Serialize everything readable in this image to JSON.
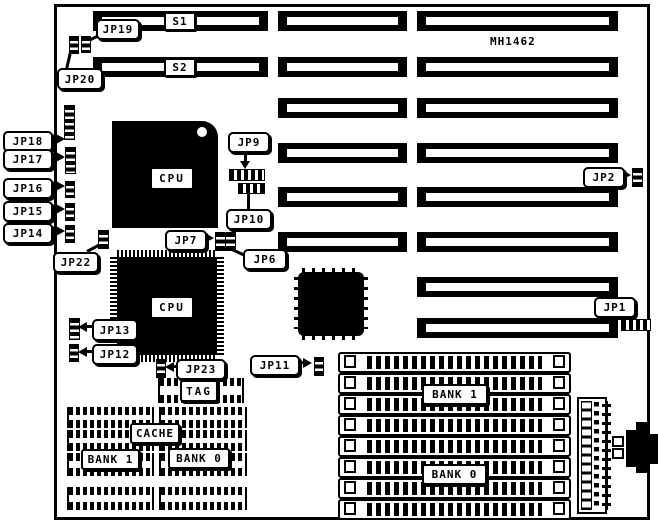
{
  "board": {
    "model_label": "MH1462"
  },
  "slots": {
    "s1_label": "S1",
    "s2_label": "S2"
  },
  "chips": {
    "cpu1_label": "CPU",
    "cpu2_label": "CPU",
    "tag_label": "TAG",
    "cache_label": "CACHE",
    "cache_bank1_label": "BANK 1",
    "cache_bank0_label": "BANK 0"
  },
  "memory": {
    "bank1_label": "BANK 1",
    "bank0_label": "BANK 0"
  },
  "jumpers": {
    "jp1": "JP1",
    "jp2": "JP2",
    "jp6": "JP6",
    "jp7": "JP7",
    "jp9": "JP9",
    "jp10": "JP10",
    "jp11": "JP11",
    "jp12": "JP12",
    "jp13": "JP13",
    "jp14": "JP14",
    "jp15": "JP15",
    "jp16": "JP16",
    "jp17": "JP17",
    "jp18": "JP18",
    "jp19": "JP19",
    "jp20": "JP20",
    "jp22": "JP22",
    "jp23": "JP23"
  }
}
